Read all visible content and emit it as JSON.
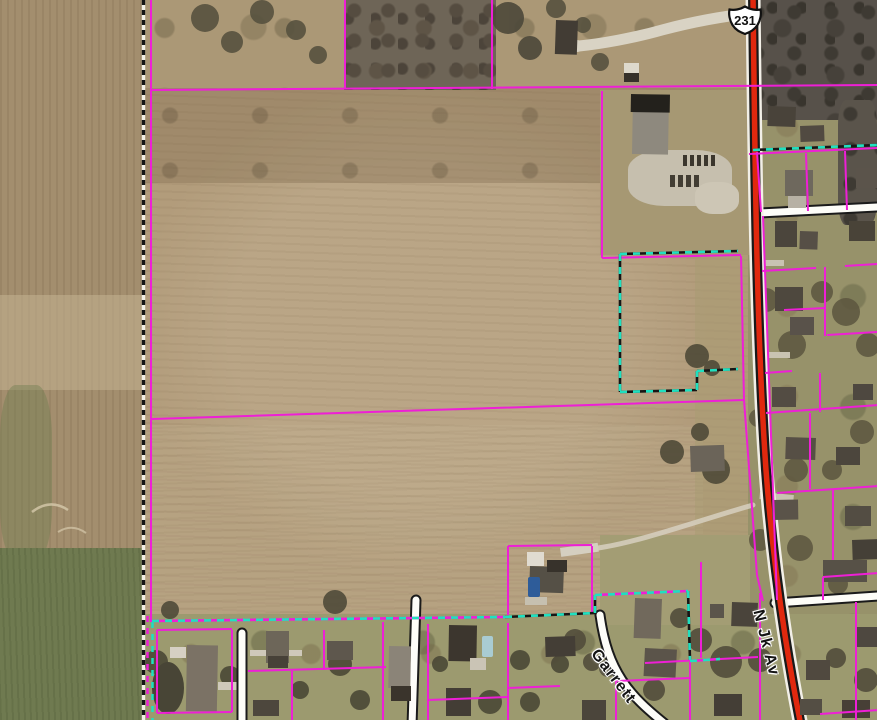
{
  "map": {
    "description": "Aerial parcel map with highlighted parcel boundaries",
    "highway_shield": {
      "route": "231"
    },
    "road_labels": [
      {
        "id": "n-jk-av",
        "text": "N Jk Av"
      },
      {
        "id": "garrett",
        "text": "Garrett"
      }
    ],
    "colors": {
      "parcel": "#ee1fd6",
      "selection": "#1fe0c0",
      "highway": "#e0280e",
      "road_fill": "#fdfdf8",
      "road_casing": "#191919"
    }
  }
}
